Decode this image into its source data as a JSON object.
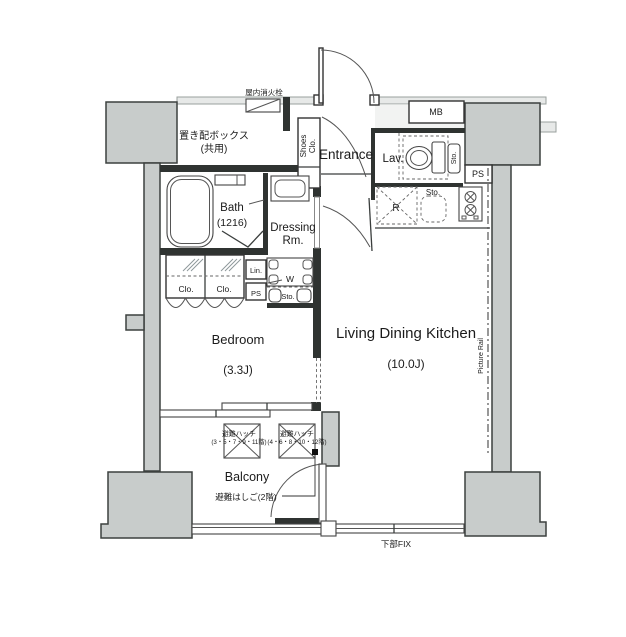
{
  "rooms": {
    "bedroom": {
      "name": "Bedroom",
      "size": "(3.3J)"
    },
    "ldk": {
      "name": "Living Dining Kitchen",
      "size": "(10.0J)"
    },
    "bath": {
      "name": "Bath",
      "size": "(1216)"
    },
    "dressing": {
      "name_line1": "Dressing",
      "name_line2": "Rm."
    },
    "entrance": {
      "name": "Entrance"
    },
    "lavatory": {
      "name": "Lav."
    },
    "balcony": {
      "name": "Balcony"
    }
  },
  "labels": {
    "indoor_fire_hydrant": "屋内消火栓",
    "parcel_box_line1": "置き配ボックス",
    "parcel_box_line2": "(共用)",
    "shoes_closet_line1": "Shoes",
    "shoes_closet_line2": "Clo.",
    "meter_box": "MB",
    "pipe_space_right": "PS",
    "pipe_space_utility": "PS",
    "linen": "Lin.",
    "washer": "W",
    "storage_lav": "Sto.",
    "storage_kitchen": "Sto.",
    "storage_utility": "Sto.",
    "refrigerator": "R",
    "closet_left": "Clo.",
    "closet_right": "Clo.",
    "picture_rail": "Picture Rail",
    "escape_hatch_a_line1": "避難ハッチ",
    "escape_hatch_a_line2": "(3・5・7・9・11階)",
    "escape_hatch_b_line1": "避難ハッチ",
    "escape_hatch_b_line2": "(4・6・8・10・12階)",
    "escape_ladder": "避難はしご(2階)",
    "fixed_window": "下部FIX"
  },
  "colors": {
    "wall_fill": "#c8cccb",
    "wall_stroke": "#3c403f",
    "dark_wall": "#2f3331",
    "light_band": "#e7e9e8",
    "text": "#1b1b1b"
  }
}
